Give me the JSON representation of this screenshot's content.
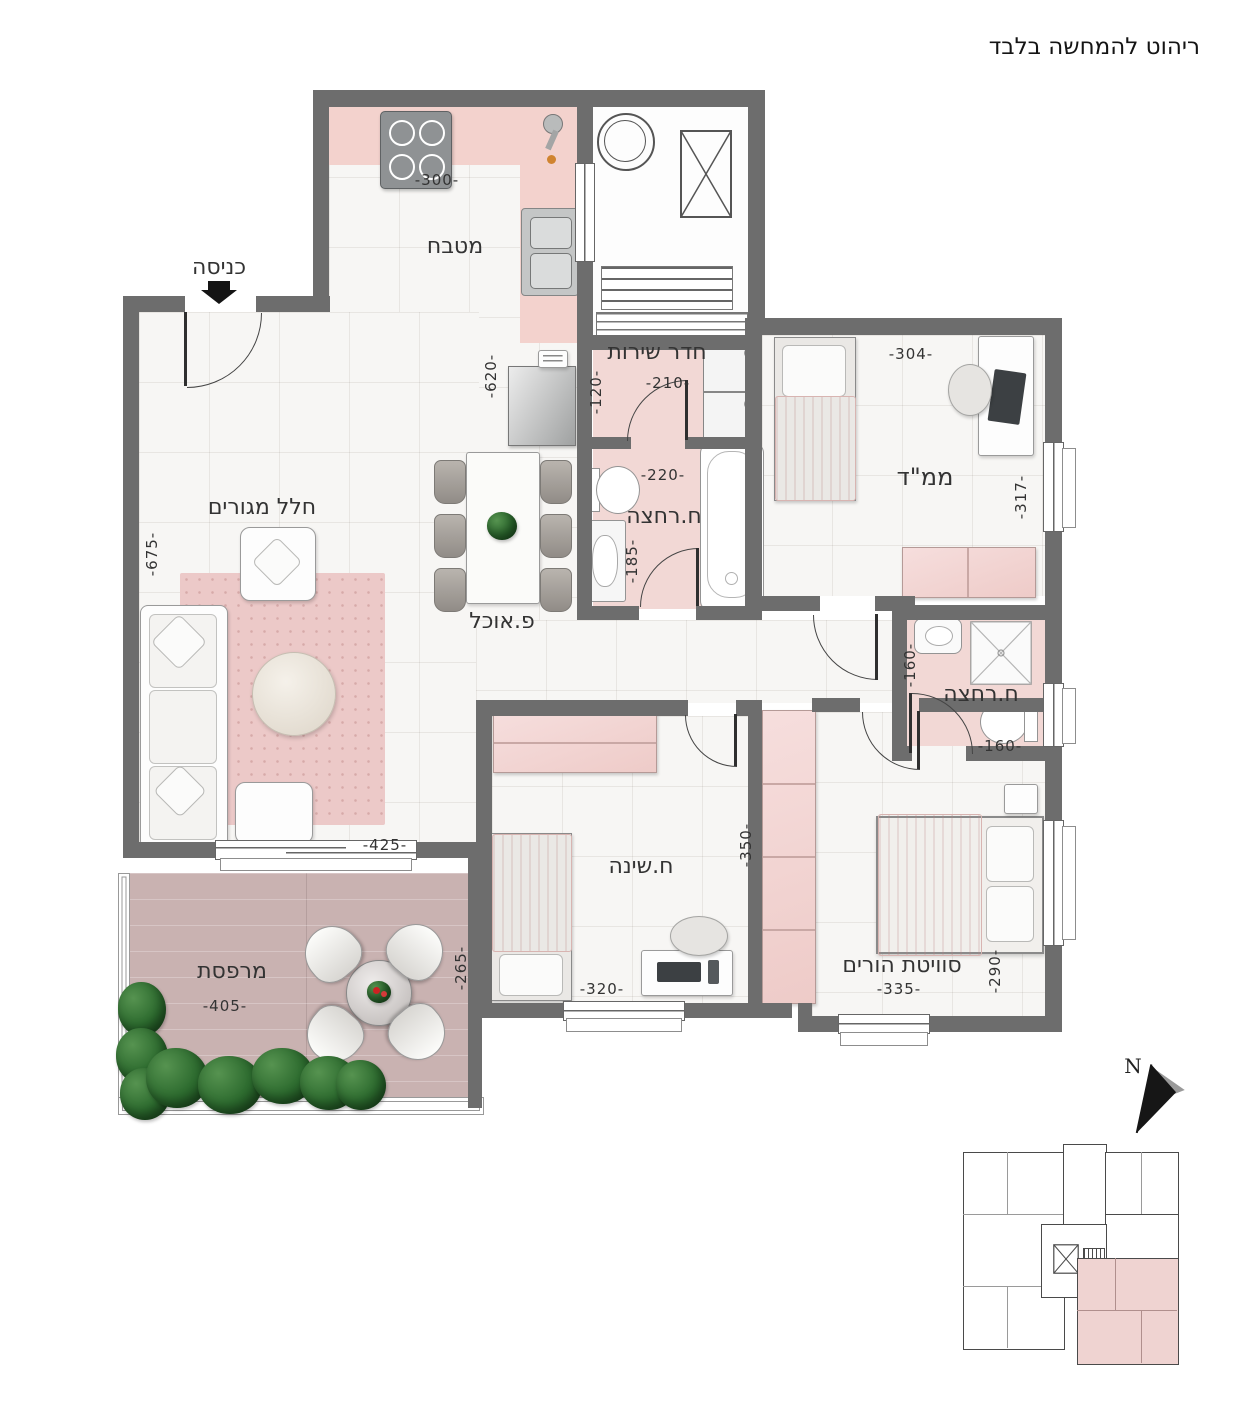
{
  "disclaimer": "ריהוט להמחשה בלבד",
  "entrance": {
    "label": "כניסה"
  },
  "rooms": {
    "kitchen": {
      "name": "מטבח",
      "dim_a": "-300-",
      "dim_b": "-620-"
    },
    "living": {
      "name": "חלל מגורים",
      "dim_a": "-675-",
      "dim_b": "-425-"
    },
    "dining": {
      "name": "פ.אוכל"
    },
    "service": {
      "name": "חדר שירות",
      "dim_a": "-210-",
      "dim_b": "-120-"
    },
    "bath1": {
      "name": "ח.רחצה",
      "dim_a": "-220-",
      "dim_b": "-185-"
    },
    "mamad": {
      "name": "ממ\"ד",
      "dim_a": "-304-",
      "dim_b": "-317-"
    },
    "bath2": {
      "name": "ח.רחצה",
      "dim_a": "-160-",
      "dim_b": "-160-"
    },
    "bedroom": {
      "name": "ח.שינה",
      "dim_a": "-320-",
      "dim_b": "-350-"
    },
    "suite": {
      "name": "סוויטת הורים",
      "dim_a": "-335-",
      "dim_b": "-290-"
    },
    "balcony": {
      "name": "מרפסת",
      "dim_a": "-405-",
      "dim_b": "-265-"
    }
  },
  "compass": {
    "north_label": "N"
  },
  "colors": {
    "wall": "#6d6d6d",
    "tile_floor": "#f7f6f4",
    "wet_floor_pink": "#f2d8d5",
    "kitchen_counter_pink": "#f3d2cd",
    "rug_pink": "#ecc9c8",
    "balcony_wood": "#c9b2b1",
    "keyplan_unit_pink": "#efd3d1",
    "plant_green": "#2c6a2e",
    "text": "#333333"
  }
}
